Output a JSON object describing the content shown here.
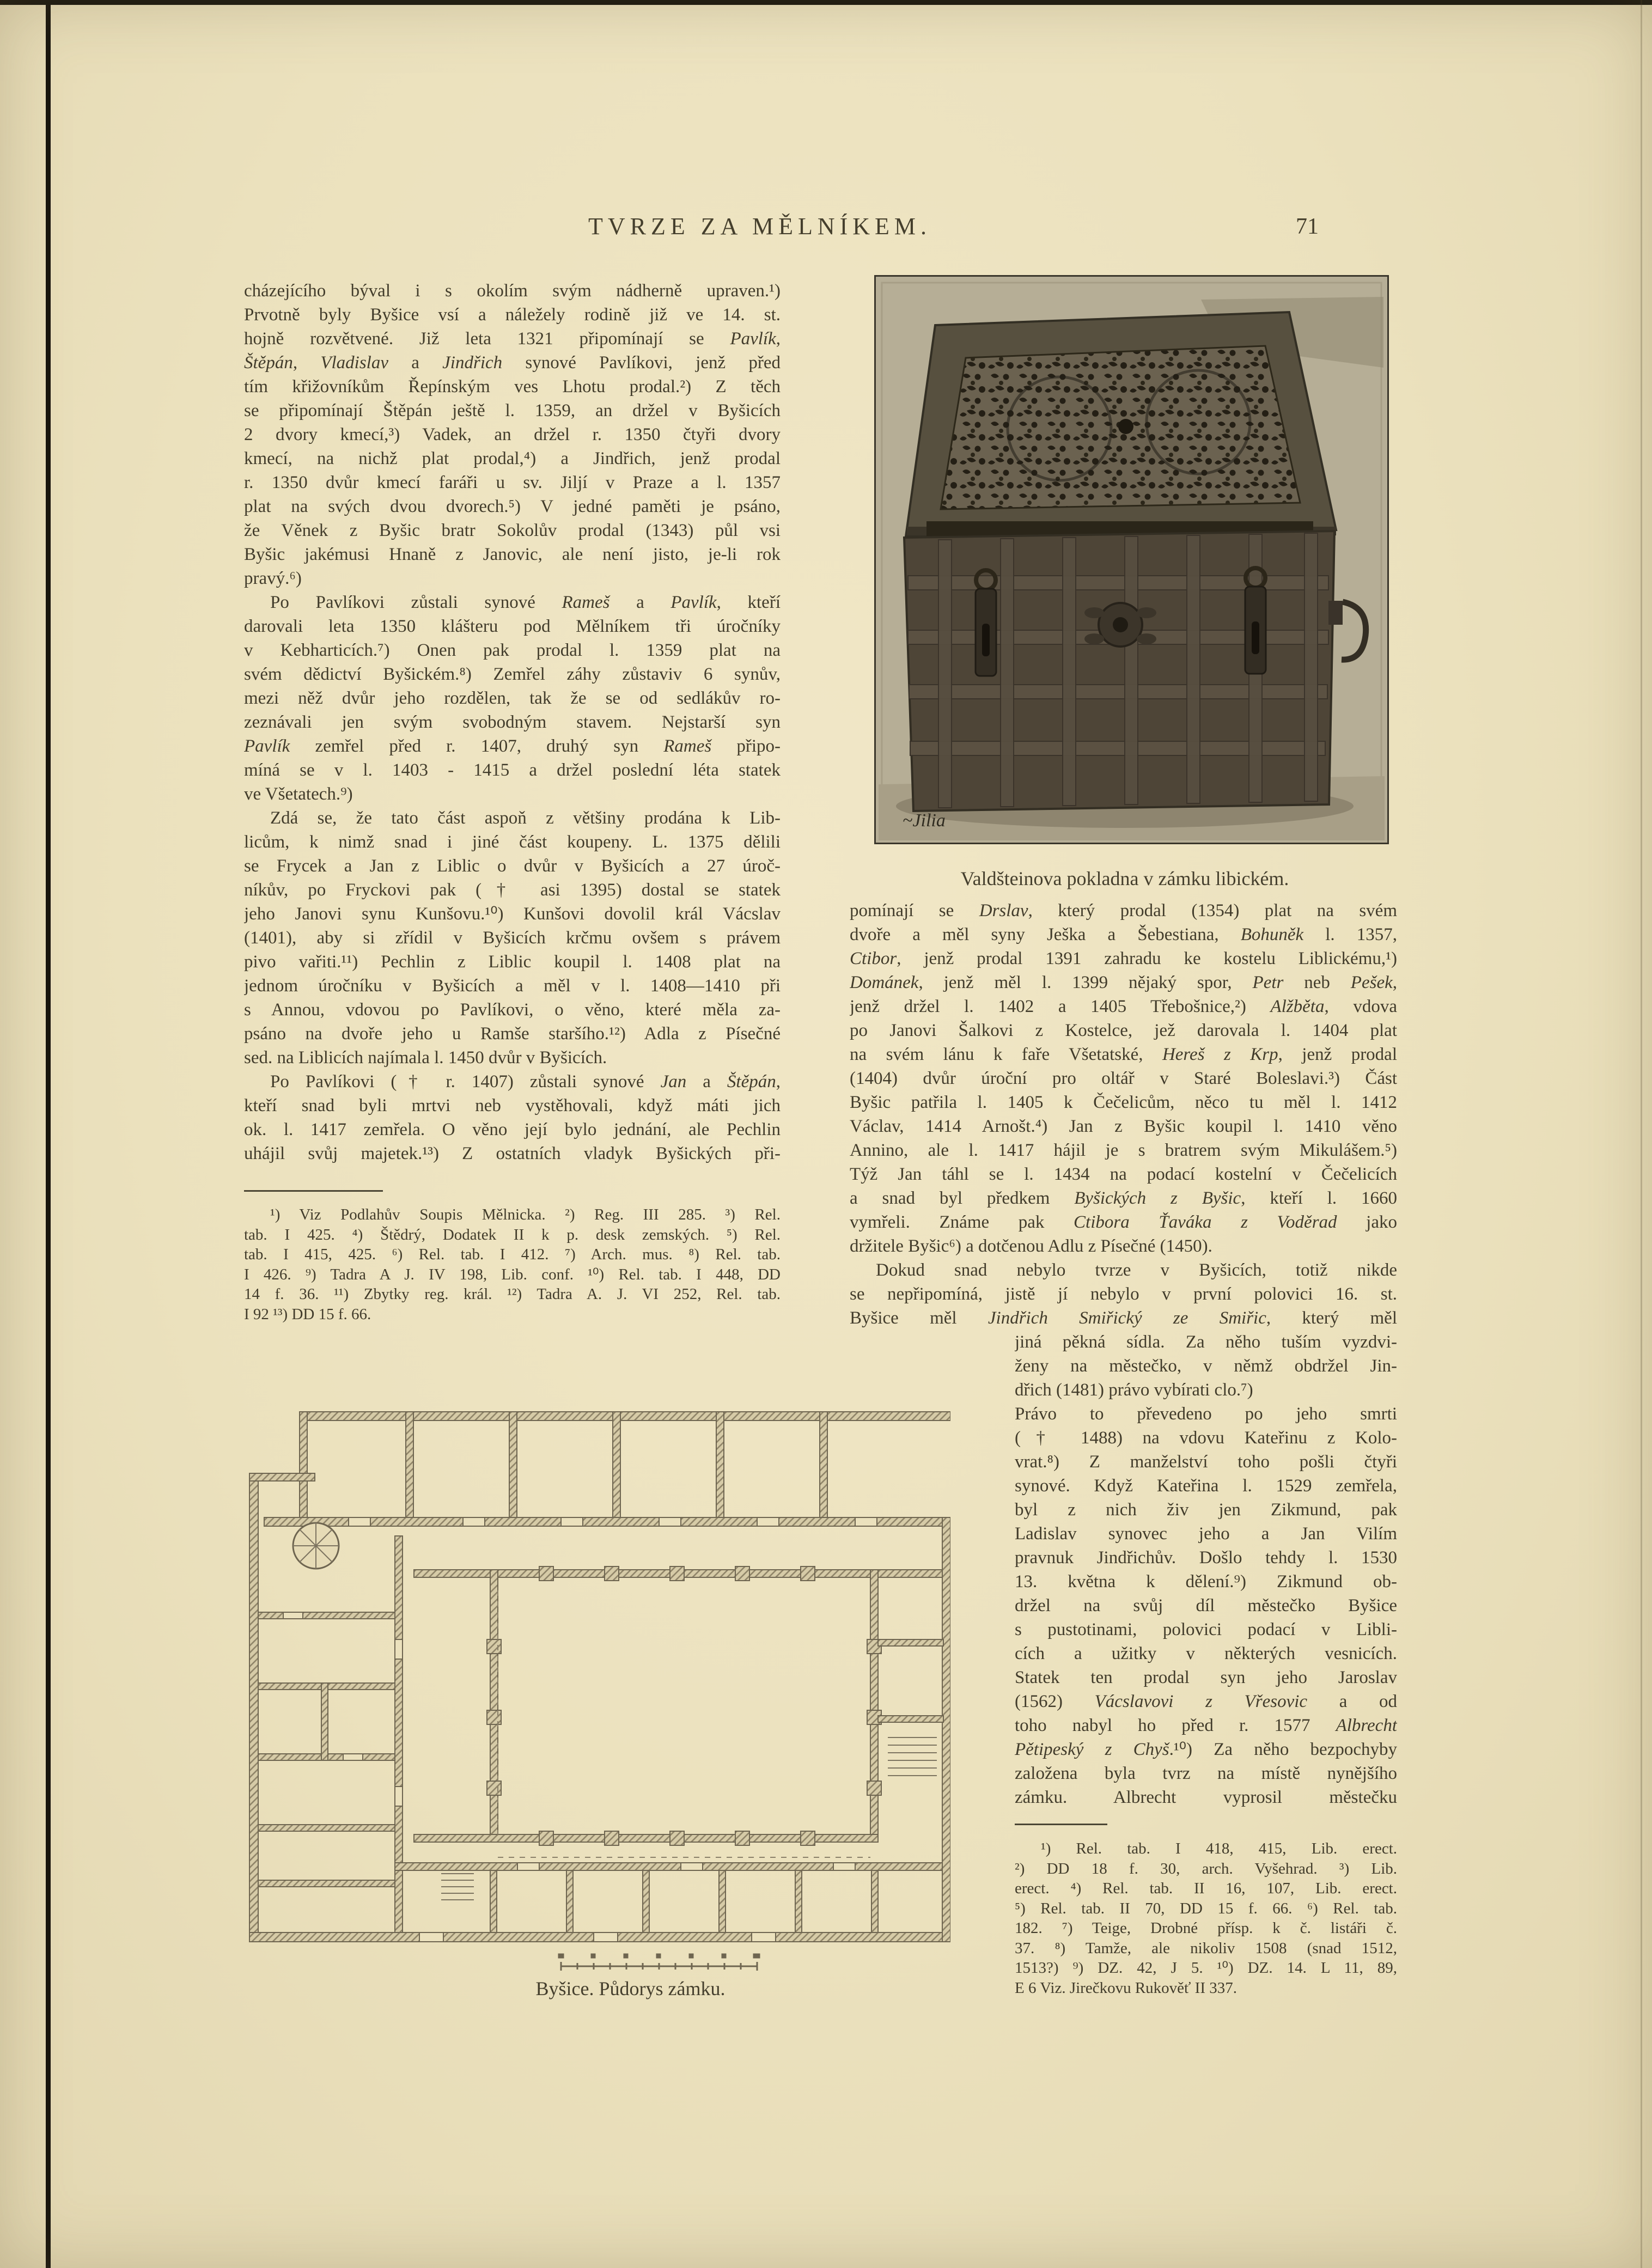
{
  "header": {
    "title": "TVRZE ZA MĚLNÍKEM.",
    "page_number": "71"
  },
  "colors": {
    "paper": "#ebe1bd",
    "ink": "#423c2b",
    "photo_background": "#b6ae96",
    "plan_line": "#8f8468"
  },
  "left_column": {
    "lines": [
      {
        "t": "cházejícího býval i s okolím svým nádherně upraven.¹)"
      },
      {
        "t": "Prvotně byly Byšice vsí a náležely rodině již ve 14. st."
      },
      {
        "t": "hojně rozvětvené. Již leta 1321 připomínají se *Pavlík*,"
      },
      {
        "t": "*Štěpán*, *Vladislav* a *Jindřich* synové Pavlíkovi, jenž před"
      },
      {
        "t": "tím křižovníkům Řepínským ves Lhotu prodal.²) Z těch"
      },
      {
        "t": "se připomínají Štěpán ještě l. 1359, an držel v Byšicích"
      },
      {
        "t": "2 dvory kmecí,³) Vadek, an držel r. 1350 čtyři dvory"
      },
      {
        "t": "kmecí, na nichž plat prodal,⁴) a Jindřich, jenž prodal"
      },
      {
        "t": "r. 1350 dvůr kmecí faráři u sv. Jiljí v Praze a l. 1357"
      },
      {
        "t": "plat na svých dvou dvorech.⁵) V jedné paměti je psáno,"
      },
      {
        "t": "že Věnek z Byšic bratr Sokolův prodal (1343) půl vsi"
      },
      {
        "t": "Byšic jakémusi Hnaně z Janovic, ale není jisto, je-li rok"
      },
      {
        "t": "pravý.⁶)",
        "end": true
      },
      {
        "t": "Po Pavlíkovi zůstali synové *Rameš* a *Pavlík*, kteří",
        "ind": true
      },
      {
        "t": "darovali leta 1350 klášteru pod Mělníkem tři úročníky"
      },
      {
        "t": "v Kebharticích.⁷)  Onen pak prodal l. 1359 plat na"
      },
      {
        "t": "svém dědictví Byšickém.⁸) Zemřel záhy zůstaviv 6 synův,"
      },
      {
        "t": "mezi něž dvůr jeho rozdělen, tak že se od sedlákův ro-"
      },
      {
        "t": "zeznávali jen svým svobodným stavem.  Nejstarší syn"
      },
      {
        "t": "*Pavlík* zemřel před r. 1407, druhý syn *Rameš* připo-"
      },
      {
        "t": "míná se v l. 1403 - 1415 a držel poslední léta statek"
      },
      {
        "t": "ve Všetatech.⁹)",
        "end": true
      },
      {
        "t": "Zdá se, že tato část aspoň z většiny prodána k Lib-",
        "ind": true
      },
      {
        "t": "licům, k nimž snad i jiné část koupeny. L. 1375 dělili"
      },
      {
        "t": "se Frycek a Jan z Liblic o dvůr v Byšicích a 27 úroč-"
      },
      {
        "t": "níkův, po Fryckovi pak († asi 1395) dostal se statek"
      },
      {
        "t": "jeho Janovi synu Kunšovu.¹⁰) Kunšovi dovolil král Vácslav"
      },
      {
        "t": "(1401), aby si zřídil v Byšicích krčmu ovšem s právem"
      },
      {
        "t": "pivo vařiti.¹¹)  Pechlin z Liblic koupil l. 1408 plat na"
      },
      {
        "t": "jednom úročníku v Byšicích a měl v l. 1408—1410 při"
      },
      {
        "t": "s Annou, vdovou po Pavlíkovi, o věno, které měla za-"
      },
      {
        "t": "psáno na dvoře jeho u Ramše staršího.¹²) Adla z Písečné"
      },
      {
        "t": "sed. na Liblicích najímala l. 1450 dvůr v Byšicích.",
        "end": true
      },
      {
        "t": "Po Pavlíkovi († r. 1407) zůstali synové *Jan* a *Štěpán*,",
        "ind": true
      },
      {
        "t": "kteří snad byli mrtvi neb vystěhovali, když máti jich"
      },
      {
        "t": "ok. l. 1417 zemřela. O věno její bylo jednání, ale Pechlin"
      },
      {
        "t": "uhájil svůj majetek.¹³) Z ostatních vladyk Byšických při-"
      }
    ],
    "footnotes": [
      {
        "t": "¹) Viz Podlahův Soupis Mělnicka. ²) Reg. III 285. ³) Rel.",
        "ind": true
      },
      {
        "t": "tab. I 425. ⁴) Štědrý, Dodatek II k p. desk zemských. ⁵) Rel."
      },
      {
        "t": "tab. I 415, 425. ⁶) Rel. tab. I 412. ⁷) Arch. mus. ⁸) Rel. tab."
      },
      {
        "t": "I 426. ⁹) Tadra A J. IV 198, Lib. conf. ¹⁰) Rel. tab. I 448, DD"
      },
      {
        "t": "14 f. 36. ¹¹) Zbytky reg. král. ¹²) Tadra A. J. VI 252, Rel. tab."
      },
      {
        "t": "I 92 ¹³) DD 15 f. 66.",
        "end": true
      }
    ]
  },
  "photo": {
    "caption": "Valdšteinova pokladna v zámku libickém.",
    "signature": "Jilia"
  },
  "right_column": {
    "lines_full": [
      {
        "t": "pomínají se *Drslav*, který prodal (1354) plat na svém"
      },
      {
        "t": "dvoře a měl syny Ješka a Šebestiana, *Bohuněk* l. 1357,"
      },
      {
        "t": "*Ctibor*, jenž prodal 1391 zahradu ke kostelu Liblickému,¹)"
      },
      {
        "t": "*Dománek*, jenž měl l. 1399 nějaký spor, *Petr* neb *Pešek*,"
      },
      {
        "t": "jenž držel l. 1402 a 1405 Třebošnice,²) *Alžběta*, vdova"
      },
      {
        "t": "po Janovi Šalkovi z Kostelce, jež darovala l. 1404 plat"
      },
      {
        "t": "na svém lánu k faře Všetatské, *Hereš z Krp*, jenž prodal"
      },
      {
        "t": "(1404) dvůr úroční pro oltář v Staré Boleslavi.³)  Část"
      },
      {
        "t": "Byšic patřila l. 1405 k Čečelicům, něco tu měl l. 1412"
      },
      {
        "t": "Václav, 1414 Arnošt.⁴)  Jan z Byšic koupil l. 1410 věno"
      },
      {
        "t": "Annino, ale l. 1417 hájil je s bratrem svým  Mikulášem.⁵)"
      },
      {
        "t": "Týž Jan táhl se l. 1434 na podací kostelní v Čečelicích"
      },
      {
        "t": "a snad byl předkem *Byšických z Byšic*, kteří l. 1660"
      },
      {
        "t": "vymřeli.  Známe pak *Ctibora Ťaváka z Voděrad* jako"
      },
      {
        "t": "držitele Byšic⁶)  a dotčenou Adlu z Písečné (1450).",
        "end": true
      },
      {
        "t": "Dokud snad nebylo tvrze v Byšicích, totiž nikde",
        "ind": true
      },
      {
        "t": "se nepřipomíná, jistě jí nebylo v první polovici 16. st."
      },
      {
        "t": "Byšice měl *Jindřich Smiřický ze Smiřic*, který měl"
      }
    ],
    "lines_narrow": [
      {
        "t": "jiná pěkná sídla. Za něho tuším vyzdvi-"
      },
      {
        "t": "ženy na městečko, v němž obdržel Jin-"
      },
      {
        "t": "dřich (1481) právo vybírati clo.⁷)",
        "end": true
      },
      {
        "t": "Právo to převedeno po jeho smrti"
      },
      {
        "t": "(† 1488) na vdovu Kateřinu z Kolo-"
      },
      {
        "t": "vrat.⁸)  Z manželství toho pošli čtyři"
      },
      {
        "t": "synové. Když Kateřina l. 1529 zemřela,"
      },
      {
        "t": "byl z nich živ jen Zikmund, pak"
      },
      {
        "t": "Ladislav synovec jeho a Jan Vilím"
      },
      {
        "t": "pravnuk Jindřichův. Došlo tehdy l. 1530"
      },
      {
        "t": "13. května k dělení.⁹)  Zikmund ob-"
      },
      {
        "t": "držel na svůj díl městečko Byšice"
      },
      {
        "t": "s pustotinami, polovici podací v Libli-"
      },
      {
        "t": "cích a užitky v některých vesnicích."
      },
      {
        "t": "Statek ten prodal syn jeho Jaroslav"
      },
      {
        "t": "(1562) *Vácslavovi z Vřesovic* a od"
      },
      {
        "t": "toho nabyl ho před r. 1577 *Albrecht*"
      },
      {
        "t": "*Pětipeský z Chyš*.¹⁰) Za něho bezpochyby"
      },
      {
        "t": "založena byla tvrz na místě nynějšího"
      },
      {
        "t": "zámku.  Albrecht vyprosil městečku"
      }
    ],
    "footnotes": [
      {
        "t": "¹) Rel. tab. I 418, 415, Lib. erect.",
        "ind": true
      },
      {
        "t": "²) DD 18 f. 30, arch. Vyšehrad. ³) Lib."
      },
      {
        "t": "erect. ⁴) Rel. tab. II 16, 107, Lib. erect."
      },
      {
        "t": "⁵) Rel. tab. II 70, DD 15 f. 66. ⁶) Rel. tab."
      },
      {
        "t": "182. ⁷) Teige, Drobné přísp. k č. listáři č."
      },
      {
        "t": "37. ⁸) Tamže, ale nikoliv 1508 (snad 1512,"
      },
      {
        "t": "1513?) ⁹) DZ. 42, J 5. ¹⁰) DZ. 14. L 11, 89,"
      },
      {
        "t": "E 6 Viz. Jirečkovu Rukověť II 337.",
        "end": true
      }
    ]
  },
  "plan": {
    "caption": "Byšice. Půdorys zámku."
  }
}
